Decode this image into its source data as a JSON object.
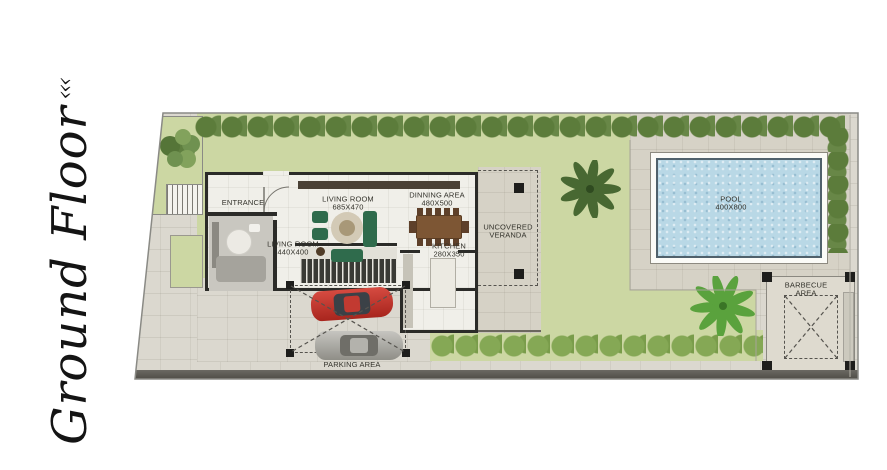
{
  "title": {
    "text": "Ground Floor",
    "flourish": "‹‹‹"
  },
  "rooms": {
    "entrance": {
      "label": "ENTRANCE"
    },
    "living_main": {
      "label": "LIVING ROOM",
      "dims": "685X470"
    },
    "living_small": {
      "label": "LIVING ROOM",
      "dims": "440X400"
    },
    "dining": {
      "label": "DINNING AREA",
      "dims": "480X500"
    },
    "kitchen": {
      "label": "KITCHEN",
      "dims": "280X350"
    },
    "veranda": {
      "label_line1": "UNCOVERED",
      "label_line2": "VERANDA"
    }
  },
  "outdoor": {
    "pool": {
      "label": "POOL",
      "dims": "400X800"
    },
    "barbecue": {
      "label_line1": "BARBECUE",
      "label_line2": "AREA"
    },
    "parking": {
      "label": "PARKING AREA"
    }
  },
  "colors": {
    "grass": "#ccd7a3",
    "hedge": "#5c7c3b",
    "bushes": "#85a855",
    "palm_dark": "#41632d",
    "palm_light": "#54a038",
    "pool_water": "#b9d8e6",
    "paving": "#dbd8cf",
    "wall": "#2b2b28",
    "floor": "#f0efe9",
    "sofa_green": "#2f6b4c",
    "table_brown": "#7d5634",
    "car_red": "#c0302a",
    "car_gray": "#b7b6b2",
    "label_text": "#33322b"
  }
}
